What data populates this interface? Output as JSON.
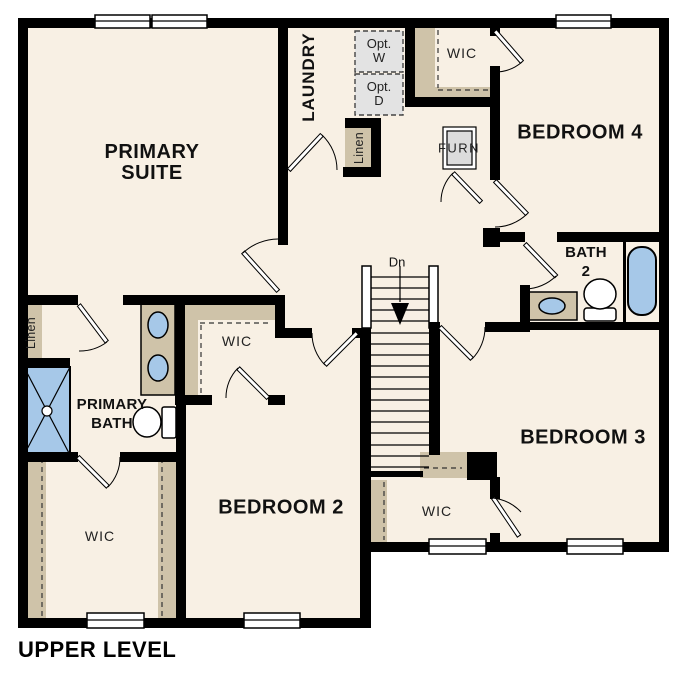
{
  "plan_title": "UPPER LEVEL",
  "colors": {
    "floor": "#f8f0e4",
    "wall": "#000000",
    "shelf": "#cfc3a9",
    "fixture": "#a6c8e8",
    "optbox": "#e3e3e3",
    "text": "#111111",
    "paper": "#ffffff"
  },
  "rooms": {
    "primary_suite": {
      "line1": "PRIMARY",
      "line2": "SUITE"
    },
    "laundry": {
      "label": "LAUNDRY"
    },
    "bedroom_4": {
      "label": "BEDROOM 4"
    },
    "bedroom_3": {
      "label": "BEDROOM 3"
    },
    "bedroom_2": {
      "label": "BEDROOM 2"
    },
    "primary_bath": {
      "line1": "PRIMARY",
      "line2": "BATH"
    },
    "bath_2": {
      "line1": "BATH",
      "line2": "2"
    },
    "wic_bedroom4": {
      "label": "WIC"
    },
    "wic_primary": {
      "label": "WIC"
    },
    "wic_bedroom2": {
      "label": "WIC"
    },
    "wic_bedroom3": {
      "label": "WIC"
    },
    "linen_laundry": {
      "label": "Linen"
    },
    "linen_primary_bath": {
      "label": "Linen"
    }
  },
  "annotations": {
    "stair_direction": "Dn",
    "furnace": "FURN",
    "optional_washer_line1": "Opt.",
    "optional_washer_line2": "W",
    "optional_dryer_line1": "Opt.",
    "optional_dryer_line2": "D"
  }
}
